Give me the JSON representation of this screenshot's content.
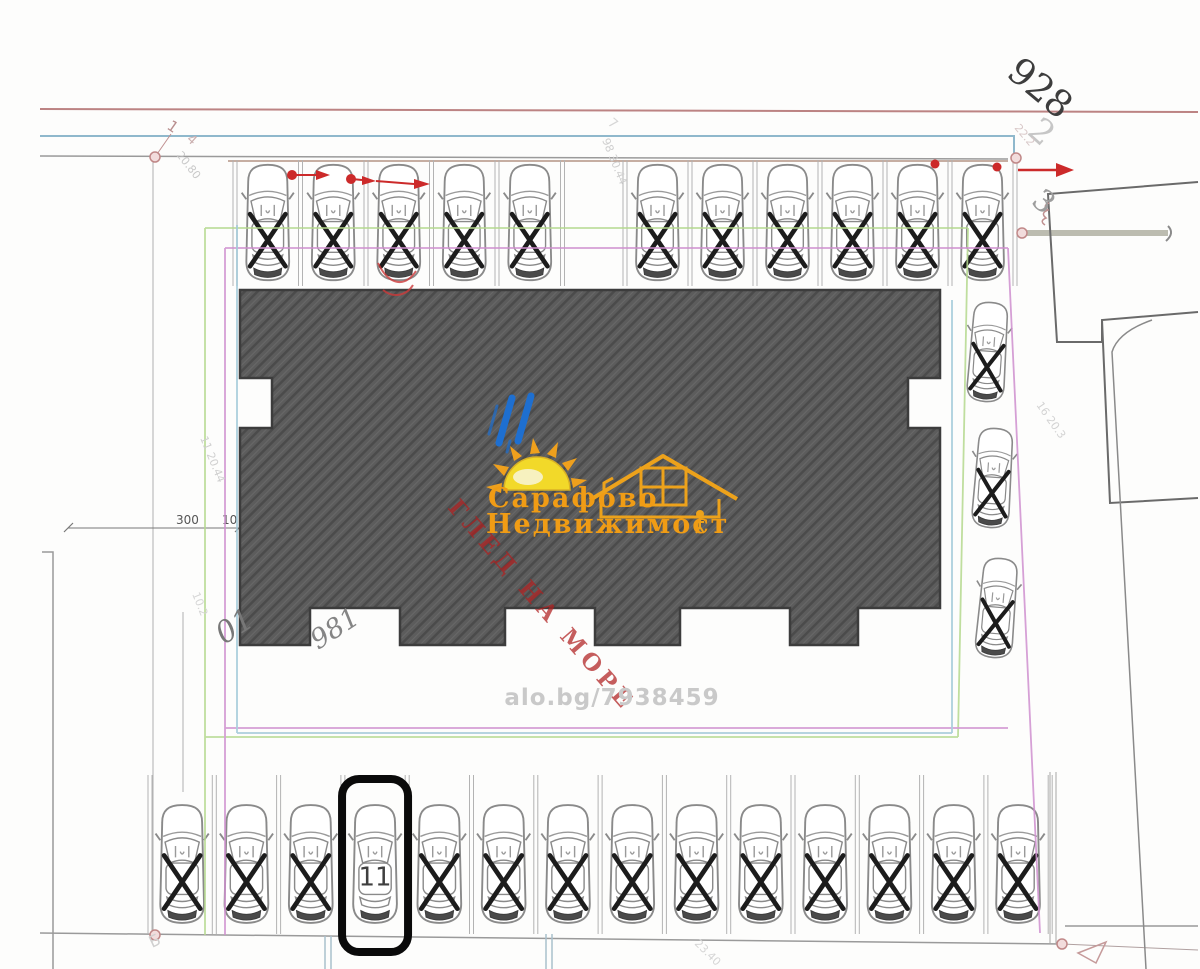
{
  "listing_ref": "alo.bg/7938459",
  "watermark": {
    "brand_line1": "Сарафово",
    "brand_line2": "Недвижимост",
    "overlay_text": "ГЛЕД НА МОРЕ"
  },
  "parking": {
    "selected_spot": {
      "label": "11"
    },
    "legend": {
      "taken_mark": "X"
    },
    "rows": {
      "top_left": {
        "spots": [
          "taken",
          "taken",
          "taken",
          "taken",
          "taken"
        ]
      },
      "top_right": {
        "spots": [
          "taken",
          "taken",
          "taken",
          "taken",
          "taken",
          "taken"
        ]
      },
      "right_column": {
        "spots": [
          "taken",
          "taken",
          "taken"
        ]
      },
      "bottom": {
        "spots": [
          "taken",
          "taken",
          "taken",
          "selected",
          "taken",
          "taken",
          "taken",
          "taken",
          "taken",
          "taken",
          "taken",
          "taken",
          "taken",
          "taken"
        ]
      }
    }
  },
  "annotations": {
    "plot_large": "928",
    "mark_2": "2",
    "mark_3": "3",
    "mark_7": "7",
    "leader_1": "1",
    "dim_4": "4",
    "dim_2080": "20.80",
    "dim_11_2044": "11  20.44",
    "dim_98_3044": "98  30.44",
    "dim_16_203": "16  20.3",
    "dim_22": "22.2",
    "dim_300": "300",
    "dim_10": "10",
    "label_01": "01",
    "label_981": "981",
    "label_b": "Б",
    "dim_2340": "23.40",
    "dim_102": "10.2"
  },
  "colors": {
    "building_fill": "#5c5c5c",
    "highlight_ring": "#0a0a0a",
    "brand_orange": "#f09c15",
    "sun_yellow": "#f2d929",
    "overlay_red": "#b02020",
    "boundary_red": "#bc8383",
    "boundary_blue": "#8fb8cc",
    "boundary_green": "#b5d98e",
    "boundary_magenta": "#cf8fcf",
    "marker_red": "#cc2a2a"
  }
}
